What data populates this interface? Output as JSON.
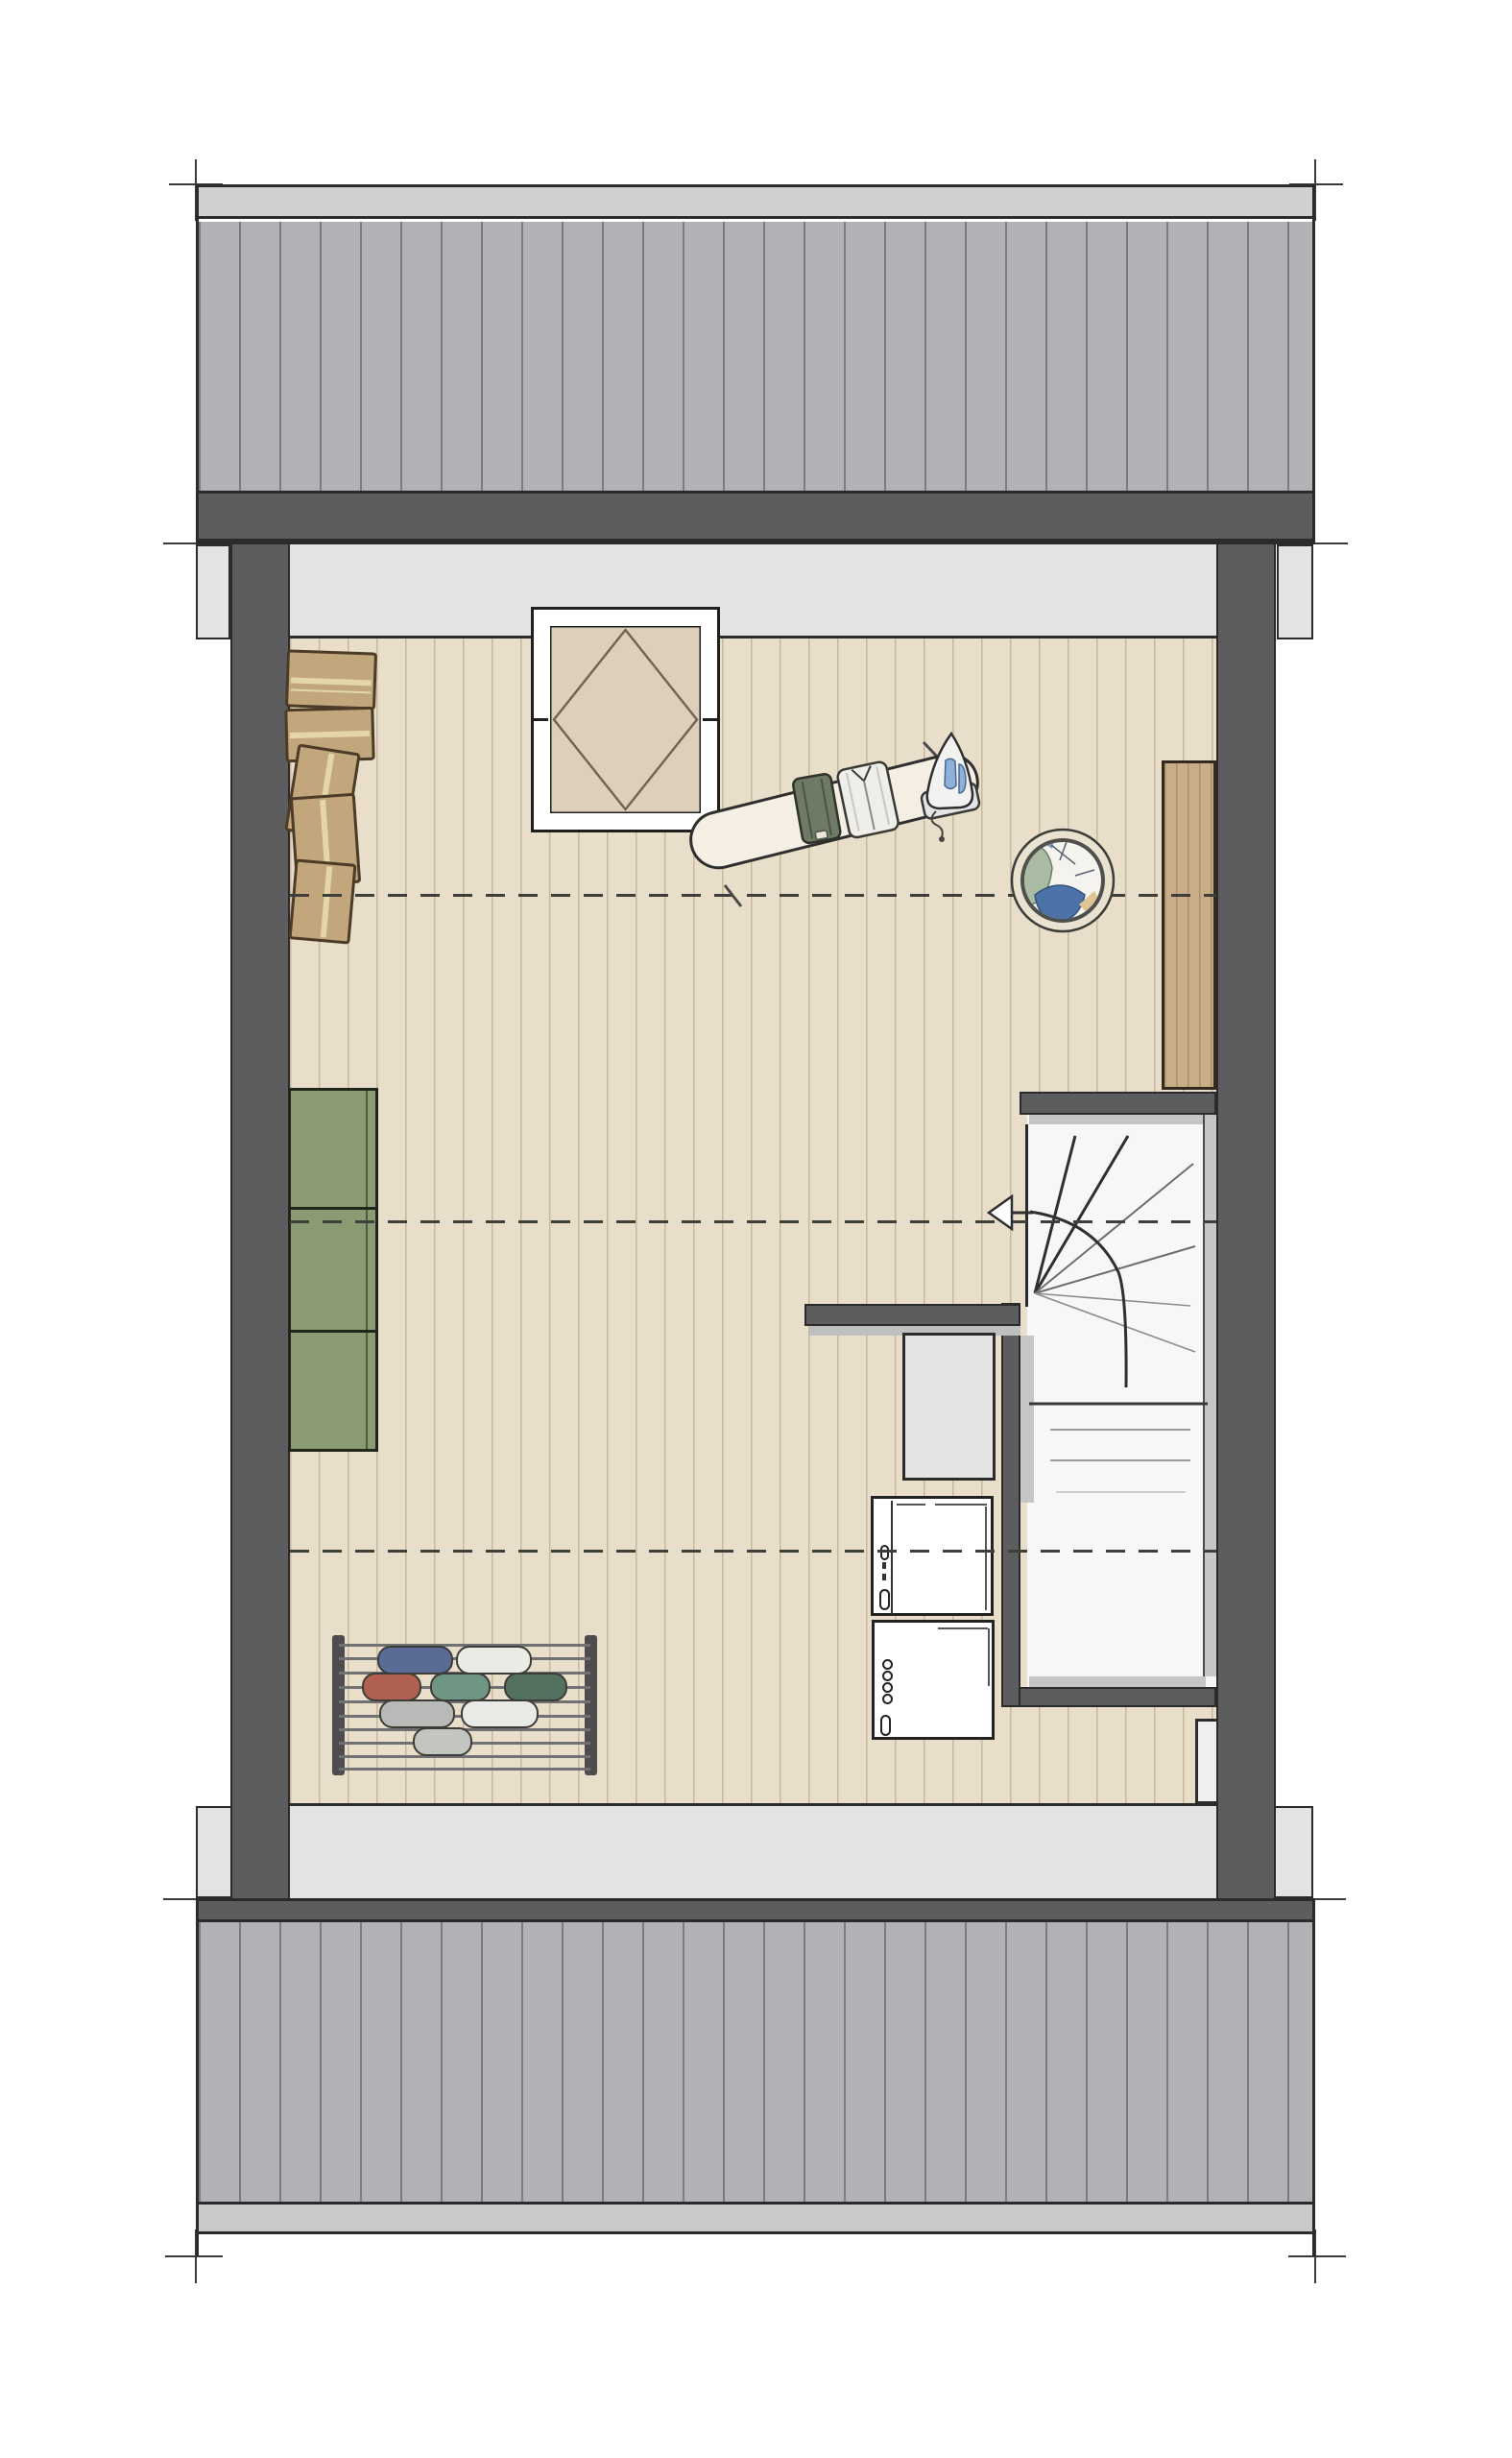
{
  "palette": {
    "outline": "#2b2b2b",
    "roof_tile": "#b2b2b6",
    "ridge": "#d0d0d0",
    "eave_strip": "#c9c9c9",
    "wall_dark": "#5d5d5f",
    "eave": "#e3e3e3",
    "knee_strip": "#e4e3e1",
    "floor": "#e9dec9",
    "dash_line": "#3f3f39",
    "rw_panel": "#dcd0bb",
    "box_tan": "#c2a67c",
    "box_tape": "#e9dcae",
    "cabinet_green": "#8a9a72",
    "wood_panel": "#c9ad89",
    "closet_gray": "#e4e4e2",
    "stair_white": "#f7f7f8",
    "stair_lining": "#c6c6c6",
    "basket_rim": "#e9e2d1",
    "basket_ring": "#4f4f4b",
    "laundry_white": "#f4f3ee",
    "laundry_green": "#a9bba2",
    "laundry_blue": "#4c72a8",
    "laundry_tan": "#e0c495",
    "board_cream": "#f5eee2",
    "garment_green": "#6f7a65",
    "garment_white": "#efeee8",
    "iron_blue": "#8fb0d8",
    "rack_item_1": "#5a6b96",
    "rack_item_2": "#eceae4",
    "rack_item_3": "#b06050",
    "rack_item_4": "#6f9682",
    "rack_item_5": "#54705f",
    "rack_item_6": "#b7bab6",
    "rack_item_7": "#e9e9e5",
    "rack_item_8": "#c3c5c1"
  },
  "inventory": {
    "moving_boxes_count": 5,
    "drying_rack_items_count": 8,
    "washer_dryer_count": 2,
    "headroom_lines_count": 3,
    "objects": [
      "roof-top",
      "roof-bottom",
      "left-wall",
      "right-wall",
      "roof-window",
      "moving-boxes",
      "ironing-board",
      "iron",
      "laundry-basket",
      "wood-panel",
      "green-cabinet",
      "drying-rack",
      "linen-closet",
      "washing-machine",
      "dryer",
      "winder-staircase",
      "direction-arrow"
    ]
  }
}
